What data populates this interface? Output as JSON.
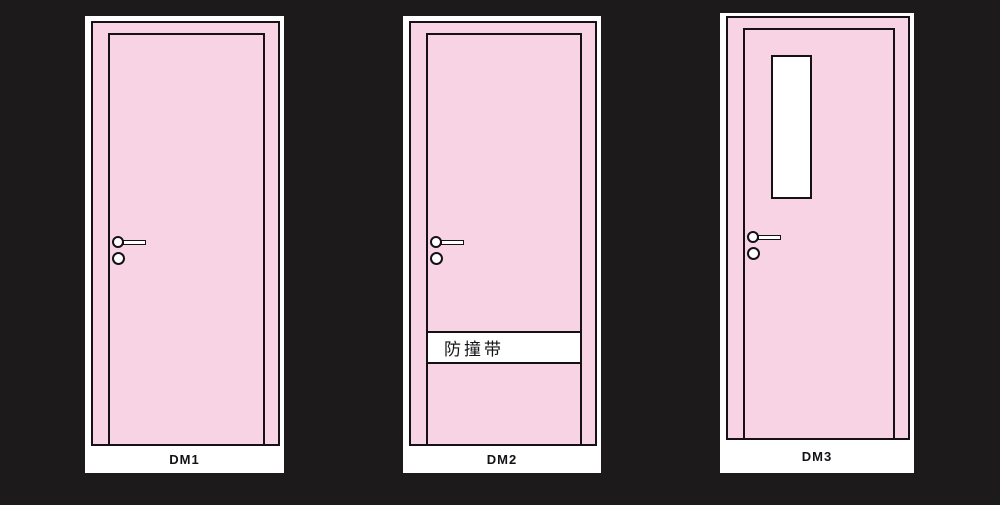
{
  "diagram": {
    "doors": [
      {
        "label": "DM1"
      },
      {
        "label": "DM2",
        "band_text": "防撞带"
      },
      {
        "label": "DM3"
      }
    ]
  },
  "icons": {
    "handle": "lever-handle-icon",
    "lock": "round-lock-knob-icon"
  },
  "colors": {
    "background": "#1d1a1b",
    "door_pink": "#f7d3e3",
    "outline": "#151117",
    "panel_white": "#ffffff",
    "label_text": "#141216"
  }
}
